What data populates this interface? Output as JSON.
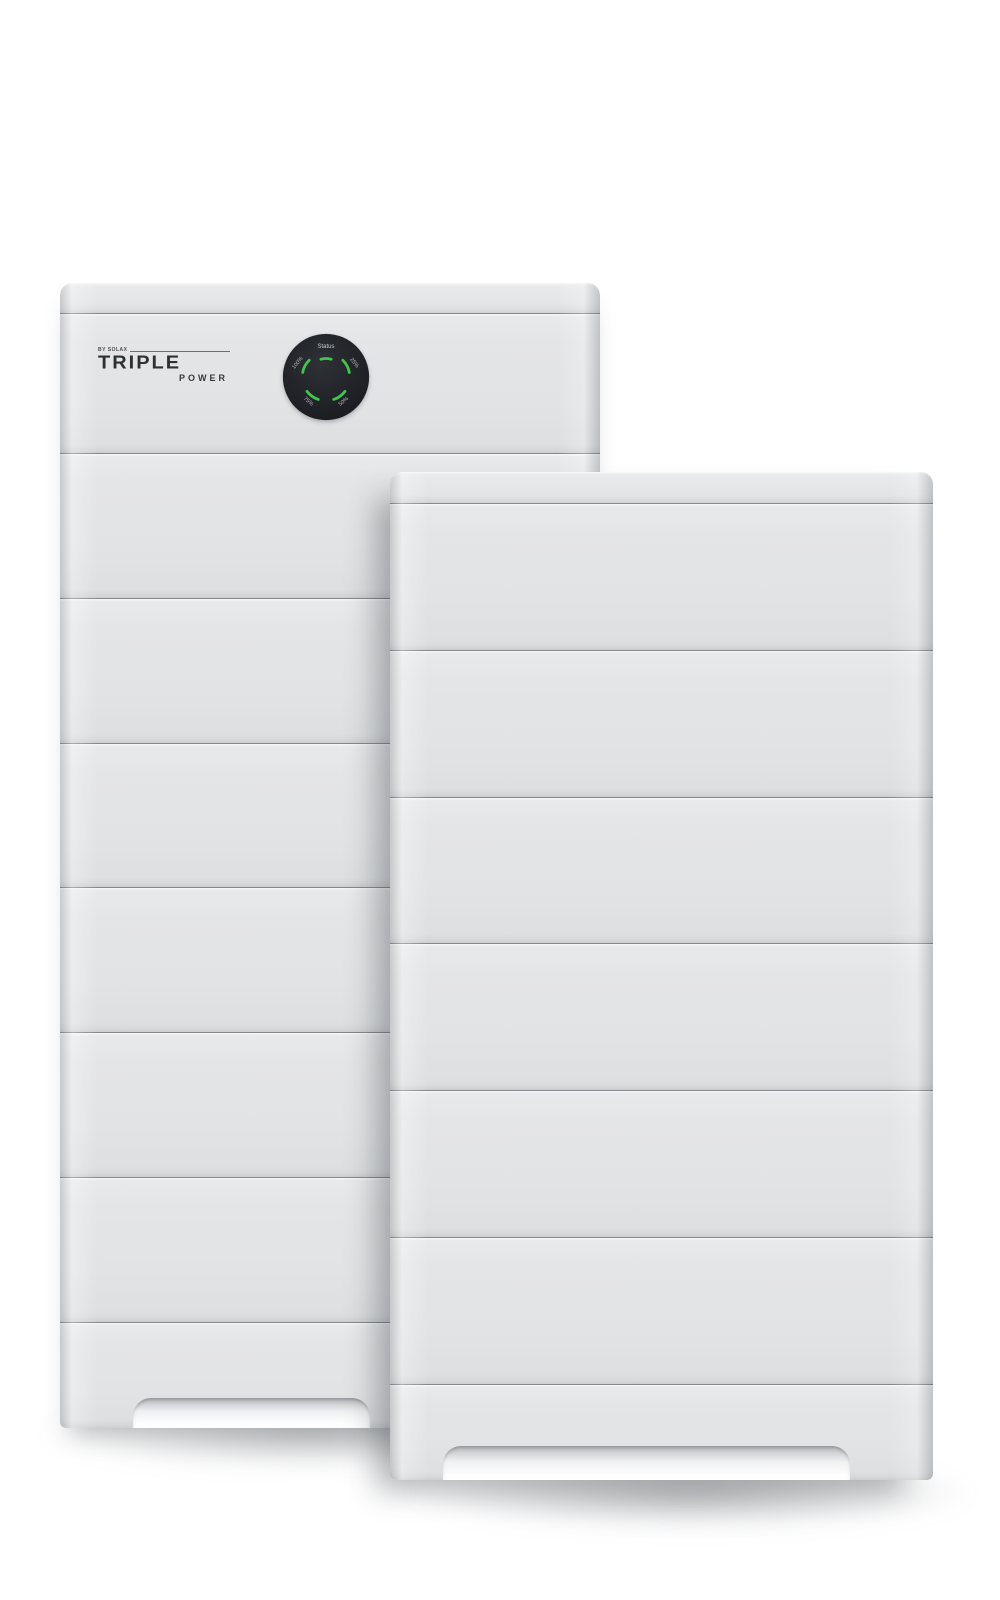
{
  "brand": {
    "byline": "BY SOLAX",
    "name": "TRIPLE",
    "subname": "POWER"
  },
  "dial": {
    "status_label": "Status",
    "levels": {
      "upper_left": "100%",
      "upper_right": "25%",
      "lower_left": "75%",
      "lower_right": "50%"
    },
    "face_color": "#1d2024",
    "led_color": "#3dc84b",
    "label_color": "#b7babd",
    "status_text_color": "#c9ccce"
  },
  "scene": {
    "background_color": "#ffffff",
    "body_color": "#e3e4e6",
    "seam_color": "#85888c",
    "back_tower_module_count": 6,
    "front_tower_module_count": 6
  }
}
